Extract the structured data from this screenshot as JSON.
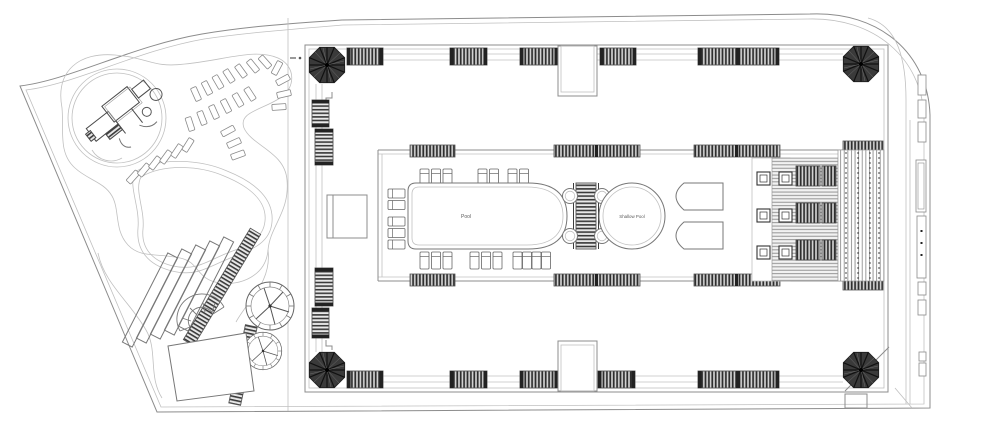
{
  "plan": {
    "pool_label": "Pool",
    "shallow_pool_label": "Shallow Pool"
  },
  "colors": {
    "background": "#ffffff",
    "line": "#8c8c8c",
    "light_line": "#c0c0c0",
    "dark_fill": "#3a3a3a",
    "stripe": "#2e2e2e"
  }
}
